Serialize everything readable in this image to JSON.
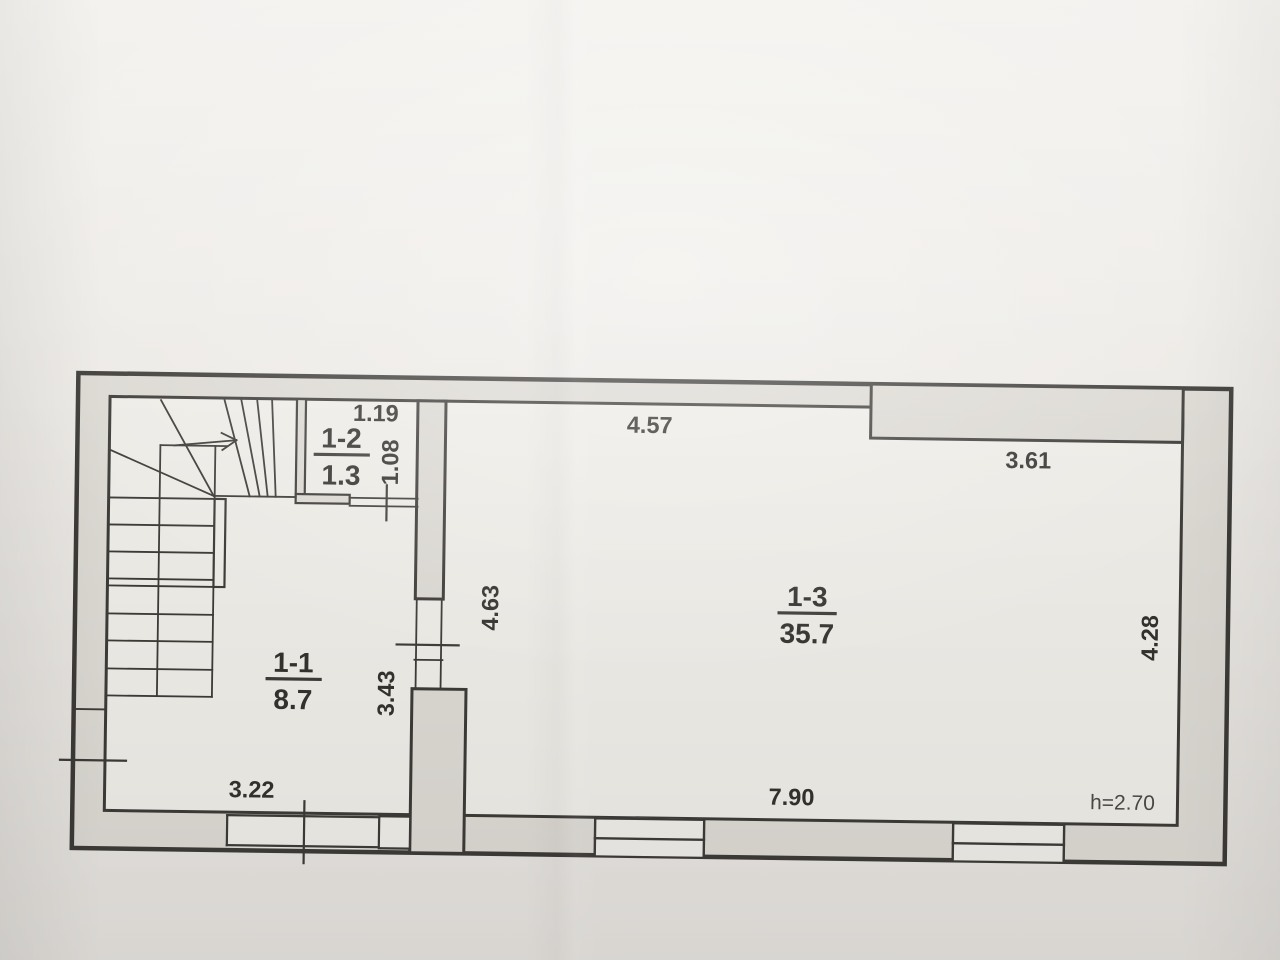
{
  "rooms": [
    {
      "number": "1-1",
      "area": "8.7"
    },
    {
      "number": "1-2",
      "area": "1.3"
    },
    {
      "number": "1-3",
      "area": "35.7"
    }
  ],
  "dimensions": {
    "room12_width": "1.19",
    "room12_height": "1.08",
    "room13_top_left": "4.57",
    "room13_top_right": "3.61",
    "room13_left_height": "4.63",
    "room13_right_height": "4.28",
    "room11_width": "3.22",
    "room11_height": "3.43",
    "room13_bottom_width": "7.90",
    "ceiling_height_note": "h=2.70"
  },
  "colors": {
    "paper_top": "#f2f0ec",
    "paper_bottom": "#e4e1dd",
    "wall": "#dcd9d3",
    "floor": "#eeece7",
    "line": "#3d3b38",
    "text": "#34322f",
    "note_text": "#4c4a46"
  }
}
